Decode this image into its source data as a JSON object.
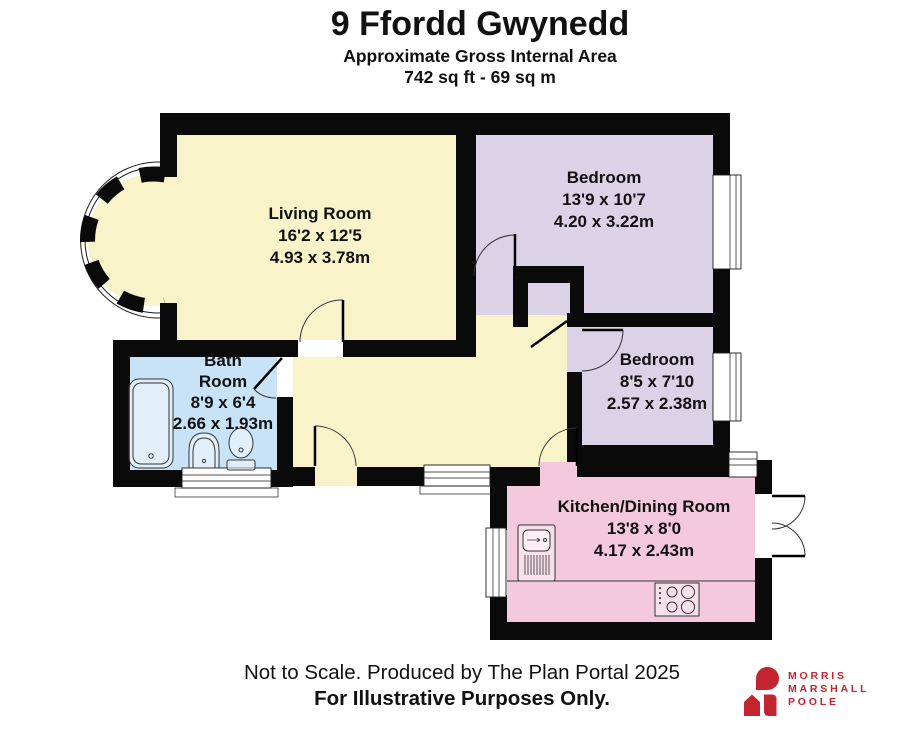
{
  "header": {
    "title": "9 Ffordd Gwynedd",
    "subtitle": "Approximate Gross Internal Area",
    "area": "742 sq ft - 69 sq m"
  },
  "rooms": [
    {
      "id": "living-room",
      "name": "Living Room",
      "dims_imperial": "16'2 x 12'5",
      "dims_metric": "4.93 x 3.78m",
      "color": "#F8F3C9"
    },
    {
      "id": "bedroom-1",
      "name": "Bedroom",
      "dims_imperial": "13'9 x 10'7",
      "dims_metric": "4.20 x 3.22m",
      "color": "#DCD2E7"
    },
    {
      "id": "bedroom-2",
      "name": "Bedroom",
      "dims_imperial": "8'5 x 7'10",
      "dims_metric": "2.57 x 2.38m",
      "color": "#DCD2E7"
    },
    {
      "id": "bathroom",
      "name_lines": [
        "Bath",
        "Room"
      ],
      "dims_imperial": "8'9 x 6'4",
      "dims_metric": "2.66 x 1.93m",
      "color": "#C8E2F7"
    },
    {
      "id": "kitchen-dining",
      "name": "Kitchen/Dining Room",
      "dims_imperial": "13'8 x 8'0",
      "dims_metric": "4.17 x 2.43m",
      "color": "#F4C9DD"
    }
  ],
  "colors": {
    "cream": "#F8F3C9",
    "lavender": "#DCD2E7",
    "blue": "#C8E2F7",
    "pink": "#F4C9DD",
    "wall": "#0a0a0a",
    "window": "#ffffff",
    "door_stroke": "#333333",
    "brand_red": "#C42430"
  },
  "footer": {
    "line1": "Not to Scale. Produced by The Plan Portal 2025",
    "line2": "For Illustrative Purposes Only."
  },
  "logo": {
    "line1": "MORRIS",
    "line2": "MARSHALL",
    "line3": "POOLE"
  }
}
